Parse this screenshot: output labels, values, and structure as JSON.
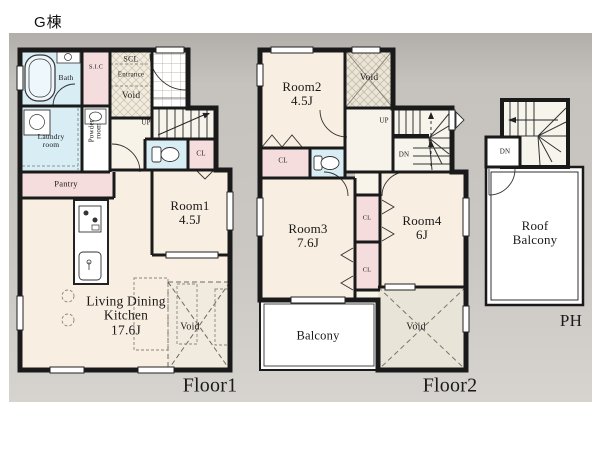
{
  "title": "G棟",
  "colors": {
    "wall": "#1a1a1a",
    "room_cream": "#f8eee1",
    "room_pink": "#f6dddd",
    "room_blue": "#d9edf5",
    "panel_gray": "#c8c4c0"
  },
  "floor1": {
    "caption": "Floor1",
    "bath": "Bath",
    "sic": "S.I.C",
    "scl": "SCL",
    "entrance": "Entrance",
    "entrance_void": "Void",
    "laundry": {
      "line1": "Laundry",
      "line2": "room"
    },
    "powder": {
      "line1": "Powder",
      "line2": "room"
    },
    "pantry": "Pantry",
    "up": "UP",
    "cl": "CL",
    "room1": {
      "name": "Room1",
      "size": "4.5J"
    },
    "ldk": {
      "line1": "Living Dining",
      "line2": "Kitchen",
      "size": "17.6J"
    },
    "void": "Void"
  },
  "floor2": {
    "caption": "Floor2",
    "room2": {
      "name": "Room2",
      "size": "4.5J"
    },
    "room3": {
      "name": "Room3",
      "size": "7.6J"
    },
    "room4": {
      "name": "Room4",
      "size": "6J"
    },
    "void_top": "Void",
    "void_bottom": "Void",
    "up": "UP",
    "dn": "DN",
    "cl_hall": "CL",
    "cl_a": "CL",
    "cl_b": "CL",
    "balcony": "Balcony"
  },
  "ph": {
    "caption": "PH",
    "dn": "DN",
    "roof_balcony": {
      "line1": "Roof",
      "line2": "Balcony"
    }
  }
}
